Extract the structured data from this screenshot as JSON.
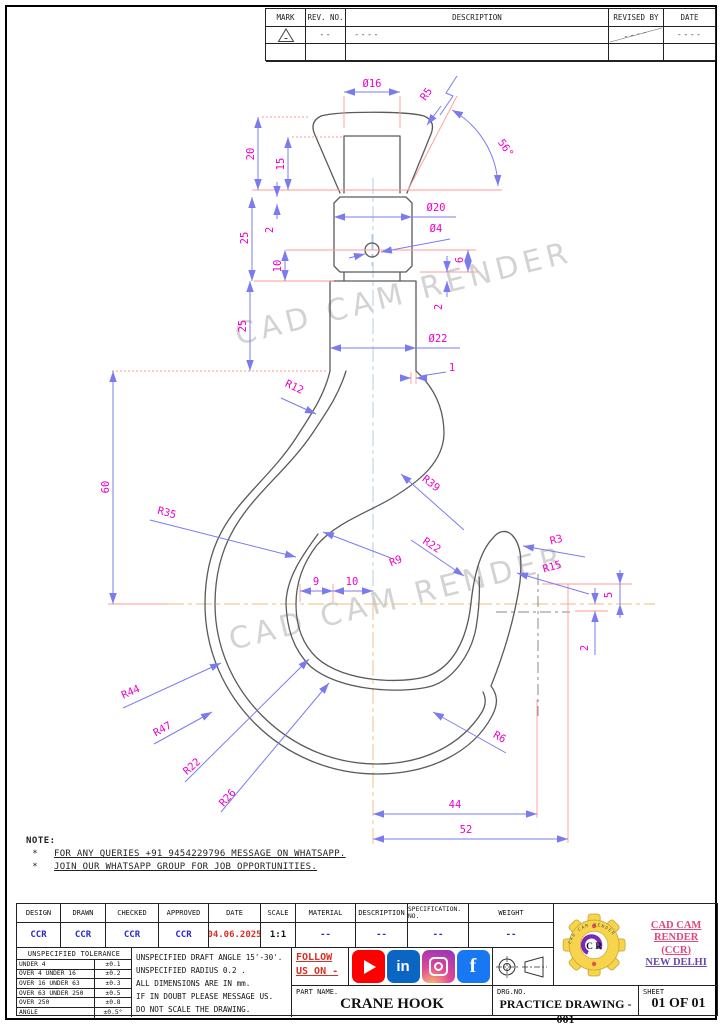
{
  "watermark": "CAD CAM RENDER",
  "revision_table": {
    "headers": [
      "MARK",
      "REV. NO.",
      "DESCRIPTION",
      "REVISED BY",
      "DATE"
    ],
    "row": {
      "rev_no": "--",
      "description": "----",
      "revised_by": "----",
      "date": "----"
    }
  },
  "dims": {
    "dia16": "Ø16",
    "r5": "R5",
    "ang56": "56°",
    "h20": "20",
    "h15": "15",
    "h25a": "25",
    "h2a": "2",
    "h10a": "10",
    "h25b": "25",
    "dia20": "Ø20",
    "dia4": "Ø4",
    "h6": "6",
    "h2b": "2",
    "dia22": "Ø22",
    "w1": "1",
    "r12": "R12",
    "h60": "60",
    "r39": "R39",
    "r35": "R35",
    "r9": "R9",
    "r22a": "R22",
    "r3": "R3",
    "r15": "R15",
    "h5": "5",
    "h2c": "2",
    "w9": "9",
    "w10": "10",
    "r44": "R44",
    "r47": "R47",
    "r22b": "R22",
    "r26": "R26",
    "r6": "R6",
    "w44": "44",
    "w52": "52"
  },
  "note": {
    "title": "NOTE:",
    "bullet": "*",
    "items": [
      "FOR ANY QUERIES +91 9454229796 MESSAGE ON WHATSAPP.",
      "JOIN OUR WHATSAPP GROUP FOR JOB OPPORTUNITIES."
    ]
  },
  "titleblock": {
    "cols": [
      {
        "label": "DESIGN",
        "value": "CCR"
      },
      {
        "label": "DRAWN",
        "value": "CCR"
      },
      {
        "label": "CHECKED",
        "value": "CCR"
      },
      {
        "label": "APPROVED",
        "value": "CCR"
      },
      {
        "label": "DATE",
        "value": "04.06.2025"
      },
      {
        "label": "SCALE",
        "value": "1:1"
      },
      {
        "label": "MATERIAL",
        "value": "--"
      },
      {
        "label": "DESCRIPTION",
        "value": "--"
      },
      {
        "label": "SPECIFICATION. NO.",
        "value": "--"
      },
      {
        "label": "WEIGHT",
        "value": "--"
      }
    ]
  },
  "tolerance": {
    "title": "UNSPECIFIED TOLERANCE",
    "rows": [
      {
        "range": "UNDER 4",
        "value": "±0.1"
      },
      {
        "range": "OVER 4 UNDER 16",
        "value": "±0.2"
      },
      {
        "range": "OVER 16 UNDER 63",
        "value": "±0.3"
      },
      {
        "range": "OVER 63 UNDER 250",
        "value": "±0.5"
      },
      {
        "range": "OVER 250",
        "value": "±0.8"
      },
      {
        "range": "ANGLE",
        "value": "±0.5°"
      }
    ]
  },
  "general_notes": {
    "lines": [
      "UNSPECIFIED DRAFT ANGLE 15'-30'.",
      "UNSPECIFIED RADIUS 0.2 .",
      "ALL DIMENSIONS ARE IN mm.",
      "IF IN DOUBT PLEASE MESSAGE US.",
      "DO NOT SCALE THE DRAWING."
    ]
  },
  "follow": {
    "line1": "FOLLOW",
    "line2": "US ON -"
  },
  "social": {
    "icons": [
      {
        "name": "youtube",
        "glyph": ""
      },
      {
        "name": "linkedin",
        "glyph": "in"
      },
      {
        "name": "instagram",
        "glyph": ""
      },
      {
        "name": "facebook",
        "glyph": "f"
      }
    ]
  },
  "part": {
    "label": "PART NAME.",
    "value": "CRANE HOOK"
  },
  "drg": {
    "label": "DRG.NO.",
    "value": "PRACTICE DRAWING - 001"
  },
  "sheet_no": {
    "label": "SHEET",
    "value": "01 OF 01"
  },
  "brand": {
    "line1": "CAD CAM RENDER",
    "line2": "(CCR)",
    "line3": "NEW DELHI",
    "gear_letters": "C R",
    "ring_text": "CAD CAM RENDER"
  },
  "colors": {
    "dimension_line": "#7b7bf0",
    "extension_line": "#ff9a9a",
    "dimension_text": "#ee00cc",
    "outline": "#5a5a5a",
    "centerline_vertical": "#a9c6e2",
    "centerline_horizontal": "#f2b87e",
    "watermark": "#c9c9c9",
    "brand_pink": "#e0457b",
    "brand_purple": "#6a48b0",
    "accent_red": "#d93025",
    "accent_blue": "#2a2ad0",
    "youtube": "#ff0000",
    "linkedin": "#0a66c2",
    "facebook": "#1877f2",
    "gear_yellow": "#f7d44c"
  }
}
